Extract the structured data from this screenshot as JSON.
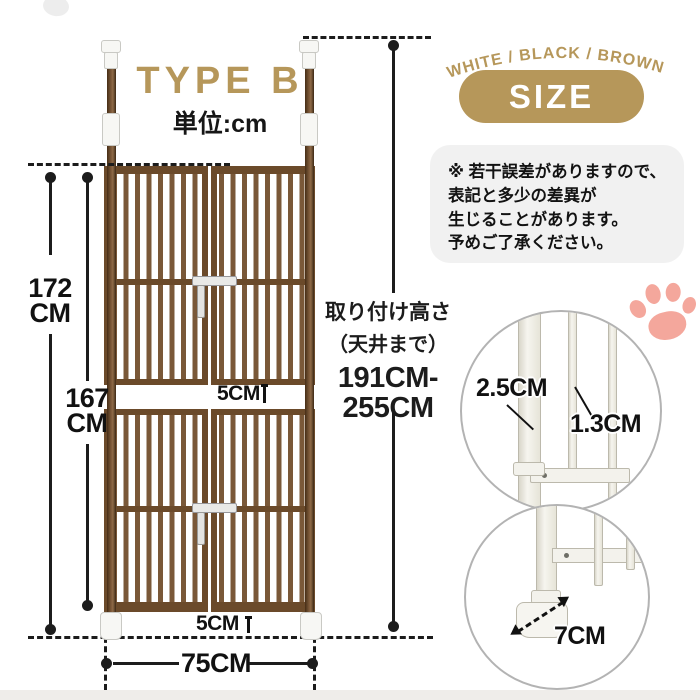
{
  "header": {
    "type_label": "TYPE B",
    "unit_label": "単位:cm",
    "color_options": "WHITE / BLACK / BROWN",
    "size_badge": "SIZE"
  },
  "notice": {
    "line1": "※ 若干誤差がありますので、",
    "line2": "表記と多少の差異が",
    "line3": "生じることがあります。",
    "line4": "予めご了承ください。"
  },
  "gate": {
    "total_height_value": "172",
    "total_height_unit": "CM",
    "panel_height_value": "167",
    "panel_height_unit": "CM",
    "middle_gap": "5CM",
    "bottom_gap": "5CM",
    "width": "75CM",
    "install_title": "取り付け高さ",
    "install_subtitle": "（天井まで）",
    "install_range_line1": "191CM-",
    "install_range_line2": "255CM"
  },
  "details": {
    "pole_thickness": "2.5CM",
    "bar_thickness": "1.3CM",
    "foot_length": "7CM"
  },
  "colors": {
    "accent_gold": "#b6975a",
    "gate_brown": "#6b4a2a",
    "paw_pink": "#f4a79c"
  }
}
